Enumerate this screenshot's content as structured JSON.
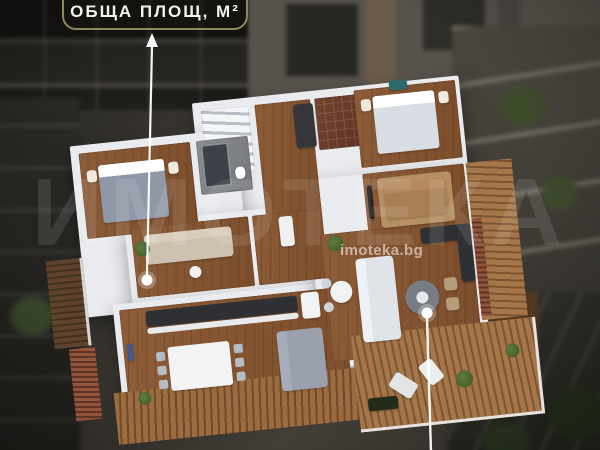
{
  "annotation": {
    "area_label": {
      "text": "ОБЩА ПЛОЩ, М²"
    },
    "markers": [
      {
        "name": "living-area-marker"
      },
      {
        "name": "terrace-marker"
      }
    ]
  },
  "watermark": {
    "logo_text": "ИМОТЕКА",
    "site_text": "imoteka.bg"
  },
  "colors": {
    "annotation_accent": "#8d8a57",
    "marker": "#ffffff",
    "wall": "#e9ebef",
    "wood_floor": "#8d5c38",
    "deck_wood": "#96693f",
    "counter_dark": "#2e3034",
    "backdrop": "#2a2925"
  },
  "floor_plan": {
    "rooms": [
      "staircase",
      "entry-hall",
      "main-bathroom",
      "bedroom-right",
      "lounge-brown-sofa",
      "bedroom-left",
      "second-bathroom",
      "living-room-beige-sofa",
      "corridor",
      "kitchen-dining",
      "living-dining-right",
      "terrace-deck",
      "side-balcony"
    ]
  }
}
